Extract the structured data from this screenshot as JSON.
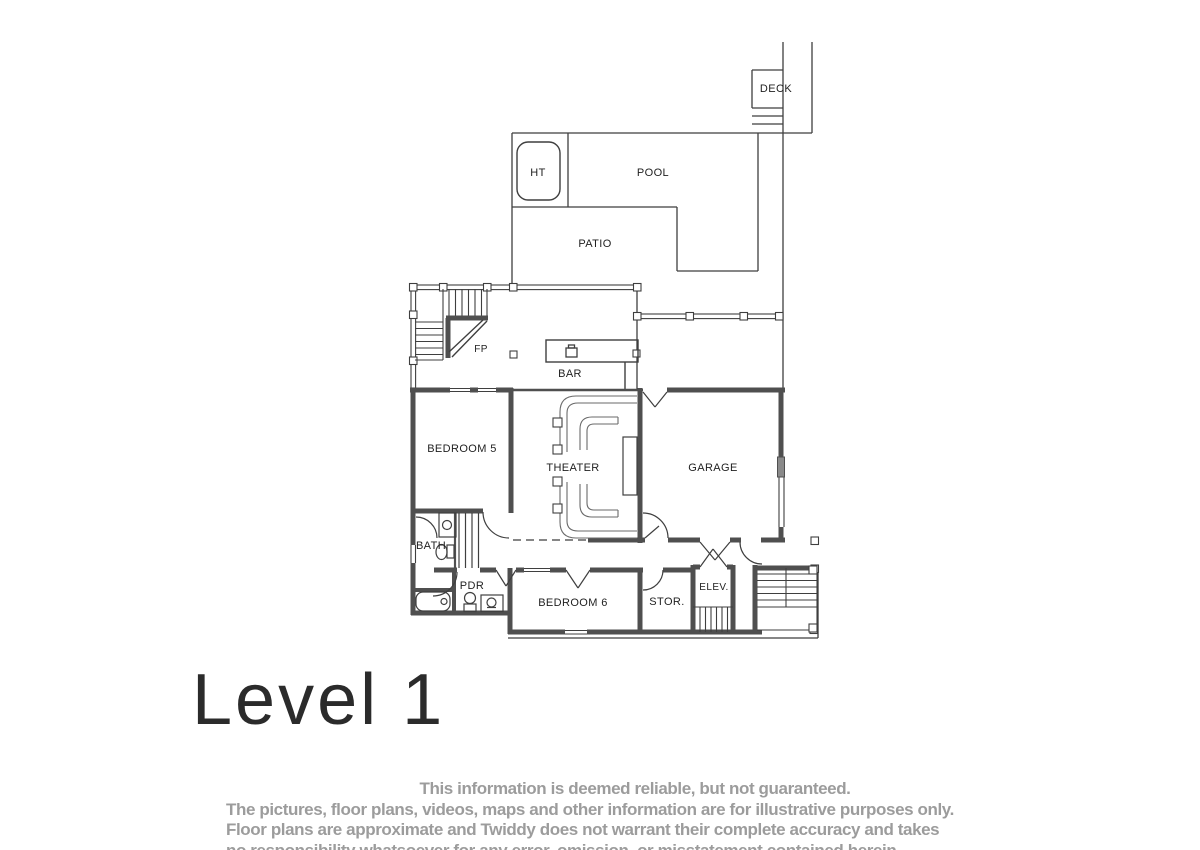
{
  "title": "Level 1",
  "rooms": {
    "deck": "DECK",
    "pool": "POOL",
    "ht": "HT",
    "patio": "PATIO",
    "fp": "FP",
    "bar": "BAR",
    "bedroom5": "BEDROOM 5",
    "theater": "THEATER",
    "garage": "GARAGE",
    "bath": "BATH",
    "pdr": "PDR",
    "bedroom6": "BEDROOM 6",
    "stor": "STOR.",
    "elev": "ELEV."
  },
  "disclaimer": {
    "line1": "This information is deemed reliable, but not guaranteed.",
    "line2": "The pictures, floor plans, videos, maps and other information are for illustrative purposes only.",
    "line3": "Floor plans are approximate and Twiddy does not warrant their complete accuracy and takes",
    "line4": "no responsibility whatsoever for any error, omission, or misstatement contained herein."
  },
  "colors": {
    "line": "#3f3f3f",
    "wall": "#4f4f4f",
    "text": "#1f1f1f",
    "disclaimer": "#9c9c9c",
    "title": "#2b2b2b"
  }
}
